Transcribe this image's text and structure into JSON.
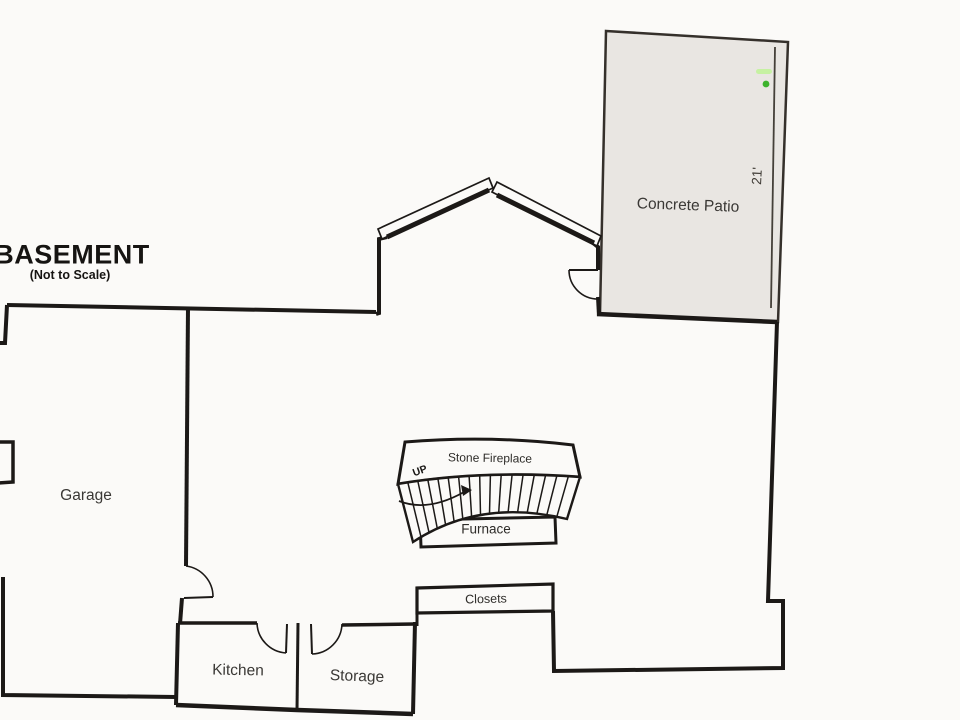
{
  "title": {
    "text": "BASEMENT",
    "subtitle": "(Not to Scale)"
  },
  "labels": {
    "garage": "Garage",
    "patio": "Concrete Patio",
    "patio_dimension": "21'",
    "kitchen": "Kitchen",
    "storage": "Storage",
    "closets": "Closets",
    "fireplace": "Stone Fireplace",
    "furnace": "Furnace",
    "stairs_direction": "UP"
  },
  "colors": {
    "paper": "#fbfaf8",
    "wall": "#1c1917",
    "title": "#161412",
    "text": "#3a3835",
    "patio_fill": "#e9e6e2",
    "patio_stroke": "#35302b",
    "dimension_line": "#454039",
    "marker_green": "#3db32c",
    "marker_green_light": "#c6f1a2"
  }
}
